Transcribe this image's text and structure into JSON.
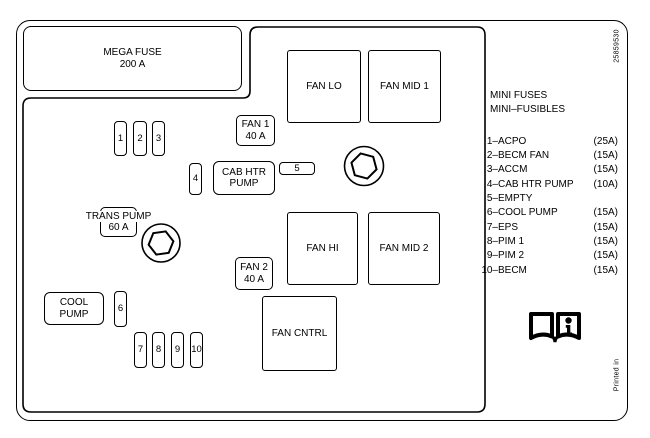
{
  "diagram": {
    "mega_fuse": {
      "line1": "MEGA FUSE",
      "line2": "200 A"
    },
    "relays": {
      "fan_lo": "FAN LO",
      "fan_mid_1": "FAN MID 1",
      "fan_hi": "FAN HI",
      "fan_mid_2": "FAN MID 2",
      "fan_cntrl": "FAN CNTRL"
    },
    "maxi_fuses": {
      "fan_1": {
        "line1": "FAN 1",
        "line2": "40 A"
      },
      "fan_2": {
        "line1": "FAN 2",
        "line2": "40 A"
      },
      "trans_pump": {
        "line1": "TRANS PUMP",
        "line2": "60 A"
      },
      "cab_htr_pump": {
        "line1": "CAB HTR",
        "line2": "PUMP"
      },
      "cool_pump": {
        "line1": "COOL",
        "line2": "PUMP"
      }
    },
    "mini_fuse_slots": [
      "1",
      "2",
      "3",
      "4",
      "5",
      "6",
      "7",
      "8",
      "9",
      "10"
    ]
  },
  "legend": {
    "heading_line1": "MINI FUSES",
    "heading_line2": "MINI–FUSIBLES",
    "items": [
      {
        "num": "1–",
        "name": "ACPO",
        "amps": "(25A)"
      },
      {
        "num": "2–",
        "name": "BECM FAN",
        "amps": "(15A)"
      },
      {
        "num": "3–",
        "name": "ACCM",
        "amps": "(15A)"
      },
      {
        "num": "4–",
        "name": "CAB HTR PUMP",
        "amps": "(10A)"
      },
      {
        "num": "5–",
        "name": "EMPTY",
        "amps": ""
      },
      {
        "num": "6–",
        "name": "COOL PUMP",
        "amps": "(15A)"
      },
      {
        "num": "7–",
        "name": "EPS",
        "amps": "(15A)"
      },
      {
        "num": "8–",
        "name": "PIM 1",
        "amps": "(15A)"
      },
      {
        "num": "9–",
        "name": "PIM 2",
        "amps": "(15A)"
      },
      {
        "num": "10–",
        "name": "BECM",
        "amps": "(15A)"
      }
    ]
  },
  "margin_notes": {
    "part_number": "25859530",
    "printed_in": "Printed in"
  },
  "icons": {
    "manual_book": "open-book-info-icon",
    "bolt": "hex-bolt-icon"
  },
  "colors": {
    "ink": "#000000",
    "paper": "#ffffff"
  }
}
